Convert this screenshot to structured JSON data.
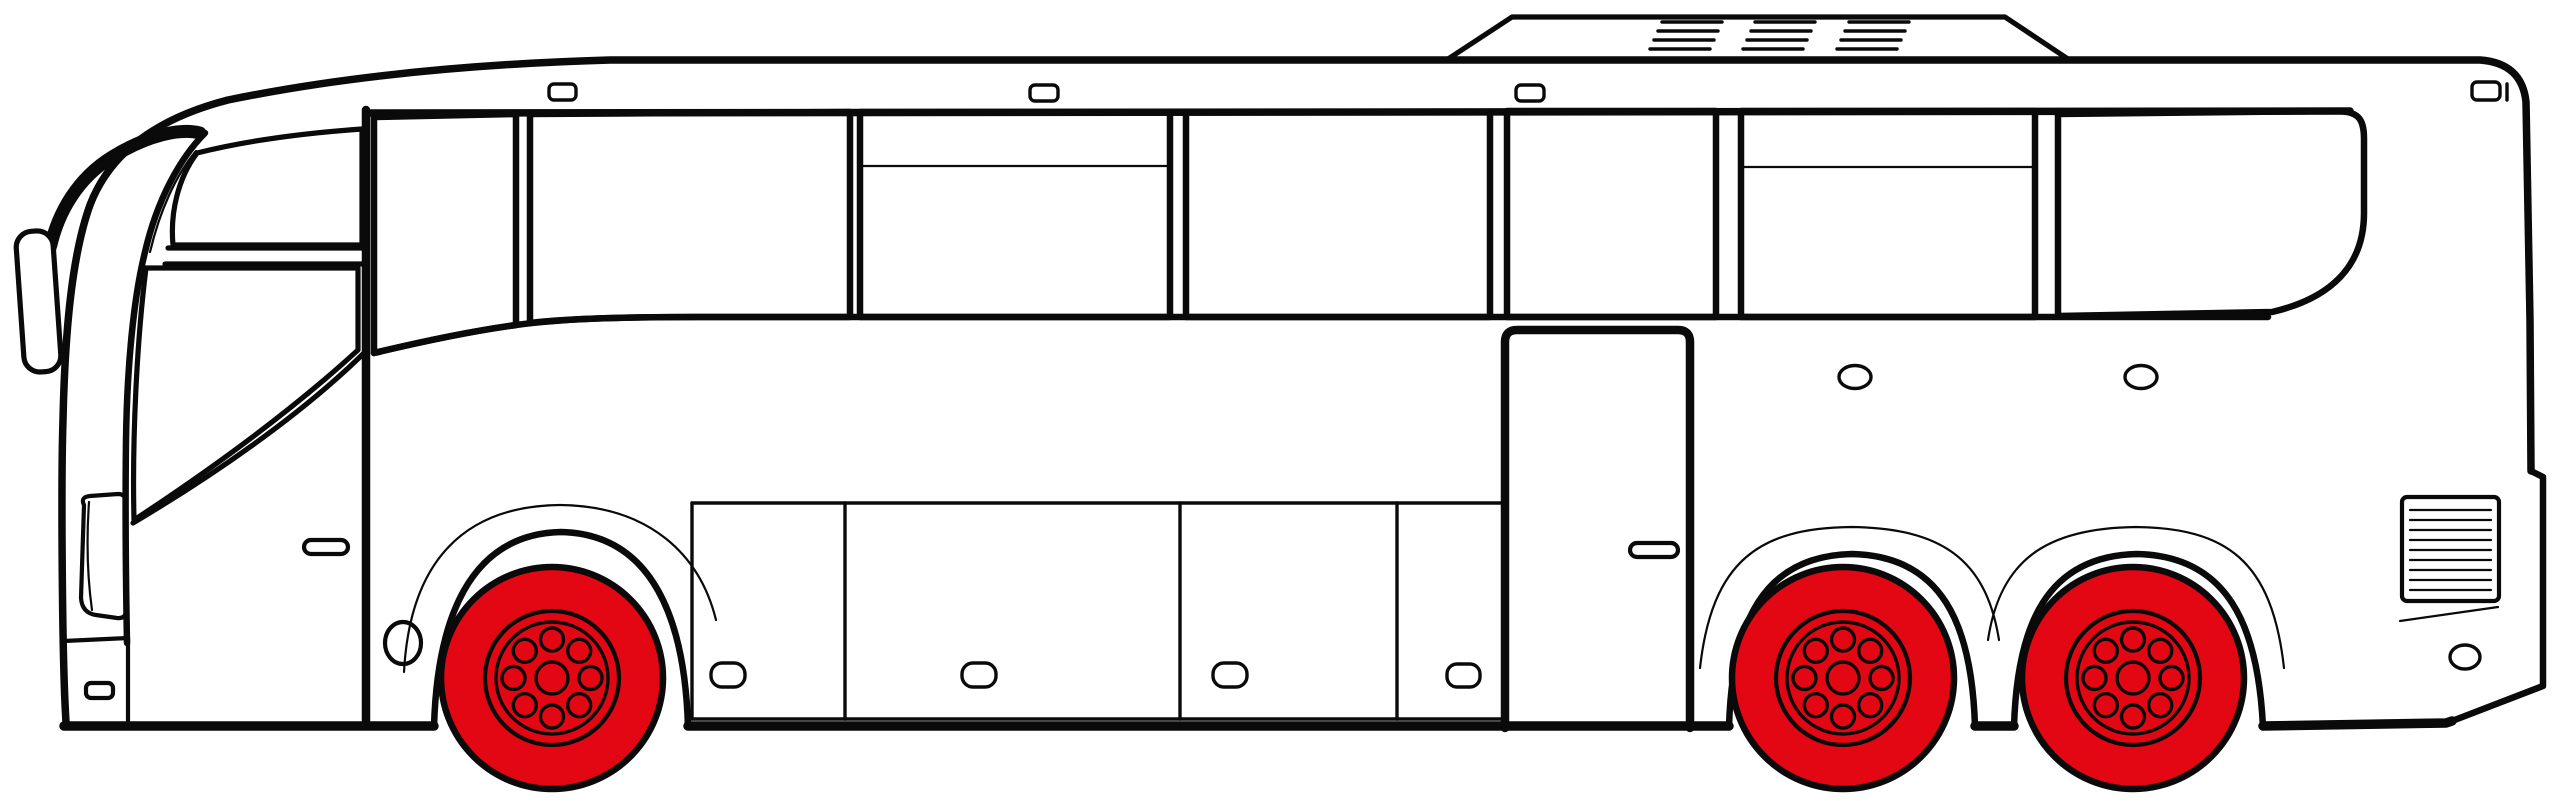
{
  "meta": {
    "title": "Side-view line drawing of a tour coach bus with red wheels",
    "vehicle": "coach-bus",
    "facing": "left"
  },
  "colors": {
    "line": "#0a0a0a",
    "wheel_red": "#e30613",
    "body_white": "#ffffff"
  },
  "bus": {
    "wheel_count": 3,
    "bolt_holes_per_wheel": 8,
    "side_window_count": 8,
    "vent_window_count": 2,
    "luggage_door_count": 4,
    "luggage_handle_count": 4,
    "passenger_door_count": 2,
    "door_handle_count": 2,
    "roof_vent_groups": 3,
    "roof_vent_slats_per_group": 4,
    "clearance_light_count": 4,
    "mirror_count": 1,
    "rear_grille_slat_count": 9
  }
}
